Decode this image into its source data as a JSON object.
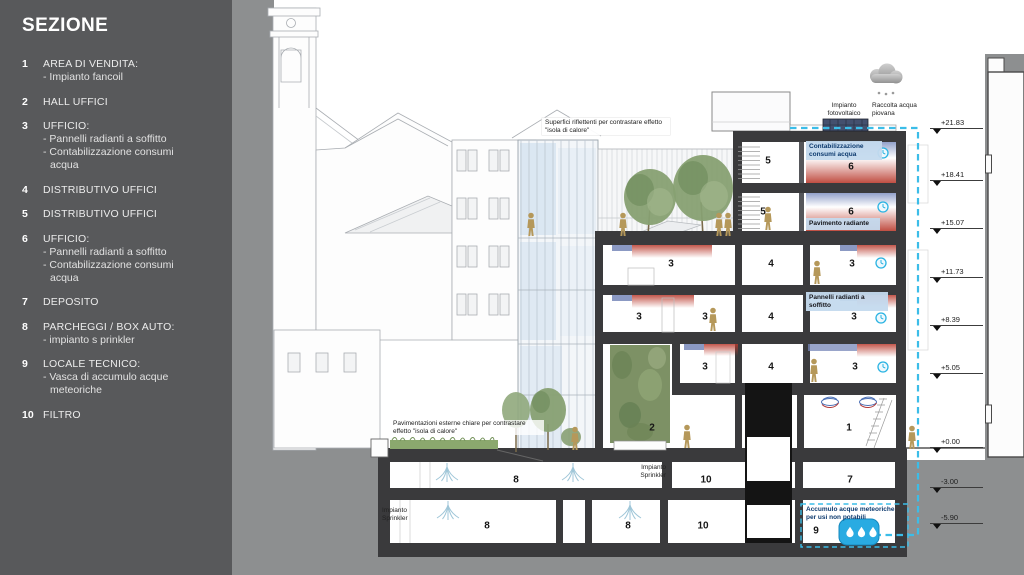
{
  "sidebar": {
    "title": "SEZIONE",
    "items": [
      {
        "num": "1",
        "title": "AREA DI VENDITA:",
        "details": [
          "- Impianto fancoil"
        ]
      },
      {
        "num": "2",
        "title": "HALL UFFICI",
        "details": []
      },
      {
        "num": "3",
        "title": "UFFICIO:",
        "details": [
          "- Pannelli radianti a soffitto",
          "- Contabilizzazione consumi",
          "acqua"
        ]
      },
      {
        "num": "4",
        "title": "DISTRIBUTIVO UFFICI",
        "details": []
      },
      {
        "num": "5",
        "title": "DISTRIBUTIVO UFFICI",
        "details": []
      },
      {
        "num": "6",
        "title": "UFFICIO:",
        "details": [
          "- Pannelli radianti a soffitto",
          "- Contabilizzazione consumi",
          "acqua"
        ]
      },
      {
        "num": "7",
        "title": "DEPOSITO",
        "details": []
      },
      {
        "num": "8",
        "title": "PARCHEGGI / BOX AUTO:",
        "details": [
          "- impianto s prinkler"
        ]
      },
      {
        "num": "9",
        "title": "LOCALE TECNICO:",
        "details": [
          "- Vasca di accumulo acque",
          "meteoriche"
        ]
      },
      {
        "num": "10",
        "title": "FILTRO",
        "details": []
      }
    ]
  },
  "annotations": {
    "reflective": "Superfici riflettenti per contrastare effetto \"isola di calore\"",
    "photovoltaic": "Impianto fotovoltaico",
    "rainwater": "Raccolta acqua piovana",
    "metering": "Contabilizzazione consumi acqua",
    "radiant_floor": "Pavimento radiante",
    "radiant_ceiling": "Pannelli radianti a soffitto",
    "paving": "Pavimentazioni esterne chiare per contrastare effetto \"isola di calore\"",
    "sprinkler_a": "Impianto Sprinkler",
    "sprinkler_b": "Impianto Sprinkler",
    "storage": "Accumulo acque meteoriche per usi non potabili"
  },
  "elevations": [
    {
      "label": "+21.83"
    },
    {
      "label": "+18.41"
    },
    {
      "label": "+15.07"
    },
    {
      "label": "+11.73"
    },
    {
      "label": "+8.39"
    },
    {
      "label": "+5.05"
    },
    {
      "label": "+0.00"
    },
    {
      "label": "-3.00"
    },
    {
      "label": "-5.90"
    }
  ],
  "rooms": [
    {
      "label": "5"
    },
    {
      "label": "6"
    },
    {
      "label": "5"
    },
    {
      "label": "6"
    },
    {
      "label": "3"
    },
    {
      "label": "4"
    },
    {
      "label": "3"
    },
    {
      "label": "3"
    },
    {
      "label": "3"
    },
    {
      "label": "4"
    },
    {
      "label": "3"
    },
    {
      "label": "3"
    },
    {
      "label": "4"
    },
    {
      "label": "3"
    },
    {
      "label": "2"
    },
    {
      "label": "1"
    },
    {
      "label": "8"
    },
    {
      "label": "10"
    },
    {
      "label": "7"
    },
    {
      "label": "8"
    },
    {
      "label": "8"
    },
    {
      "label": "10"
    },
    {
      "label": "9"
    }
  ],
  "colors": {
    "sidebar_bg": "#58595b",
    "ground_gray": "#8d8f90",
    "accent_cyan": "#3bbde8",
    "radiant_red": "#b93a2d",
    "radiant_blue": "#7787b8",
    "figure_tan": "#b5985a",
    "tank_blue": "#29abe2",
    "slab_dark": "#3a3a3c"
  }
}
